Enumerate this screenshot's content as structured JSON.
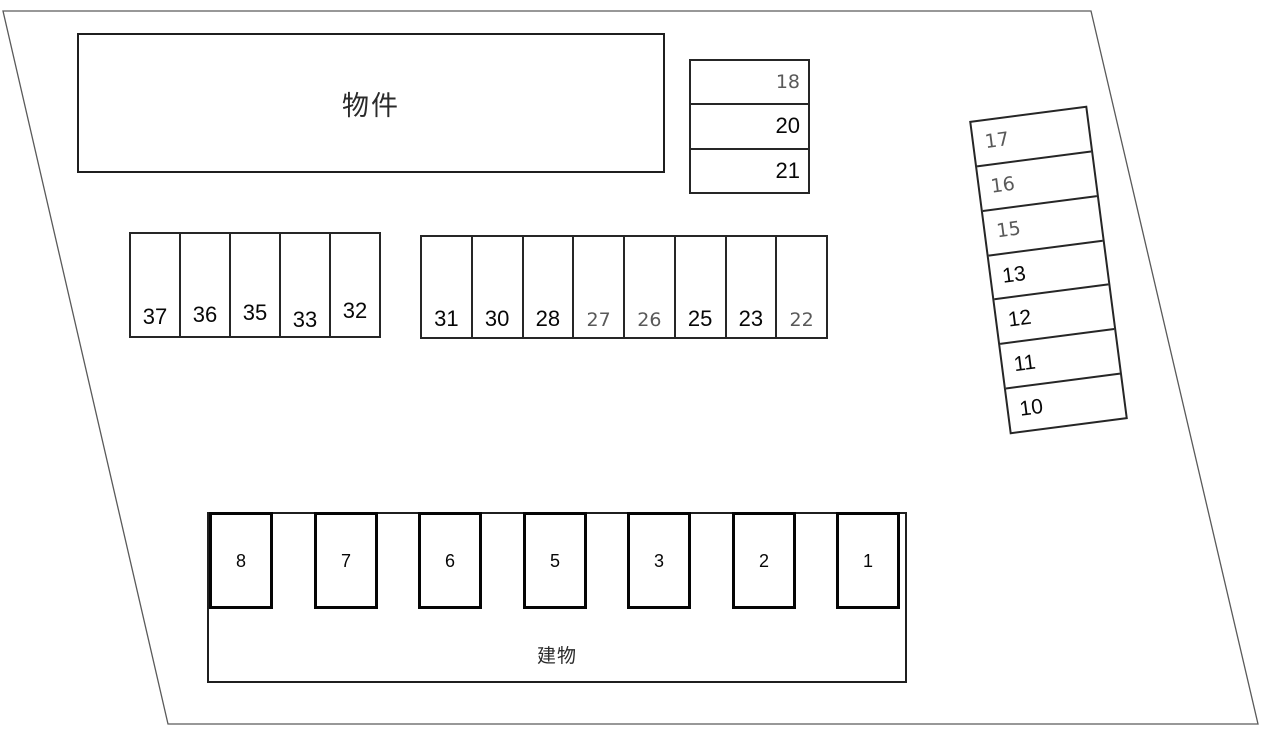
{
  "diagram": {
    "type": "parking-lot-layout",
    "property_label": "物件",
    "building_label": "建物"
  },
  "colors": {
    "background": "#ffffff",
    "site_outline": "#5a5a5a",
    "box_line": "#262626",
    "bold_box_line": "#050505",
    "number_text": "#070707",
    "number_text_muted": "#595959"
  },
  "parking": {
    "upper_stack": [
      {
        "num": "18",
        "muted": true
      },
      {
        "num": "20",
        "muted": false
      },
      {
        "num": "21",
        "muted": false
      }
    ],
    "left_row": [
      {
        "num": "37",
        "muted": false
      },
      {
        "num": "36",
        "muted": false
      },
      {
        "num": "35",
        "muted": false
      },
      {
        "num": "33",
        "muted": false
      },
      {
        "num": "32",
        "muted": false
      }
    ],
    "middle_row": [
      {
        "num": "31",
        "muted": false
      },
      {
        "num": "30",
        "muted": false
      },
      {
        "num": "28",
        "muted": false
      },
      {
        "num": "27",
        "muted": true
      },
      {
        "num": "26",
        "muted": true
      },
      {
        "num": "25",
        "muted": false
      },
      {
        "num": "23",
        "muted": false
      },
      {
        "num": "22",
        "muted": true
      }
    ],
    "right_stack": [
      {
        "num": "17",
        "muted": true
      },
      {
        "num": "16",
        "muted": true
      },
      {
        "num": "15",
        "muted": true
      },
      {
        "num": "13",
        "muted": false
      },
      {
        "num": "12",
        "muted": false
      },
      {
        "num": "11",
        "muted": false
      },
      {
        "num": "10",
        "muted": false
      }
    ],
    "bottom_row": [
      {
        "num": "8",
        "muted": false
      },
      {
        "num": "7",
        "muted": false
      },
      {
        "num": "6",
        "muted": false
      },
      {
        "num": "5",
        "muted": false
      },
      {
        "num": "3",
        "muted": false
      },
      {
        "num": "2",
        "muted": false
      },
      {
        "num": "1",
        "muted": false
      }
    ]
  }
}
